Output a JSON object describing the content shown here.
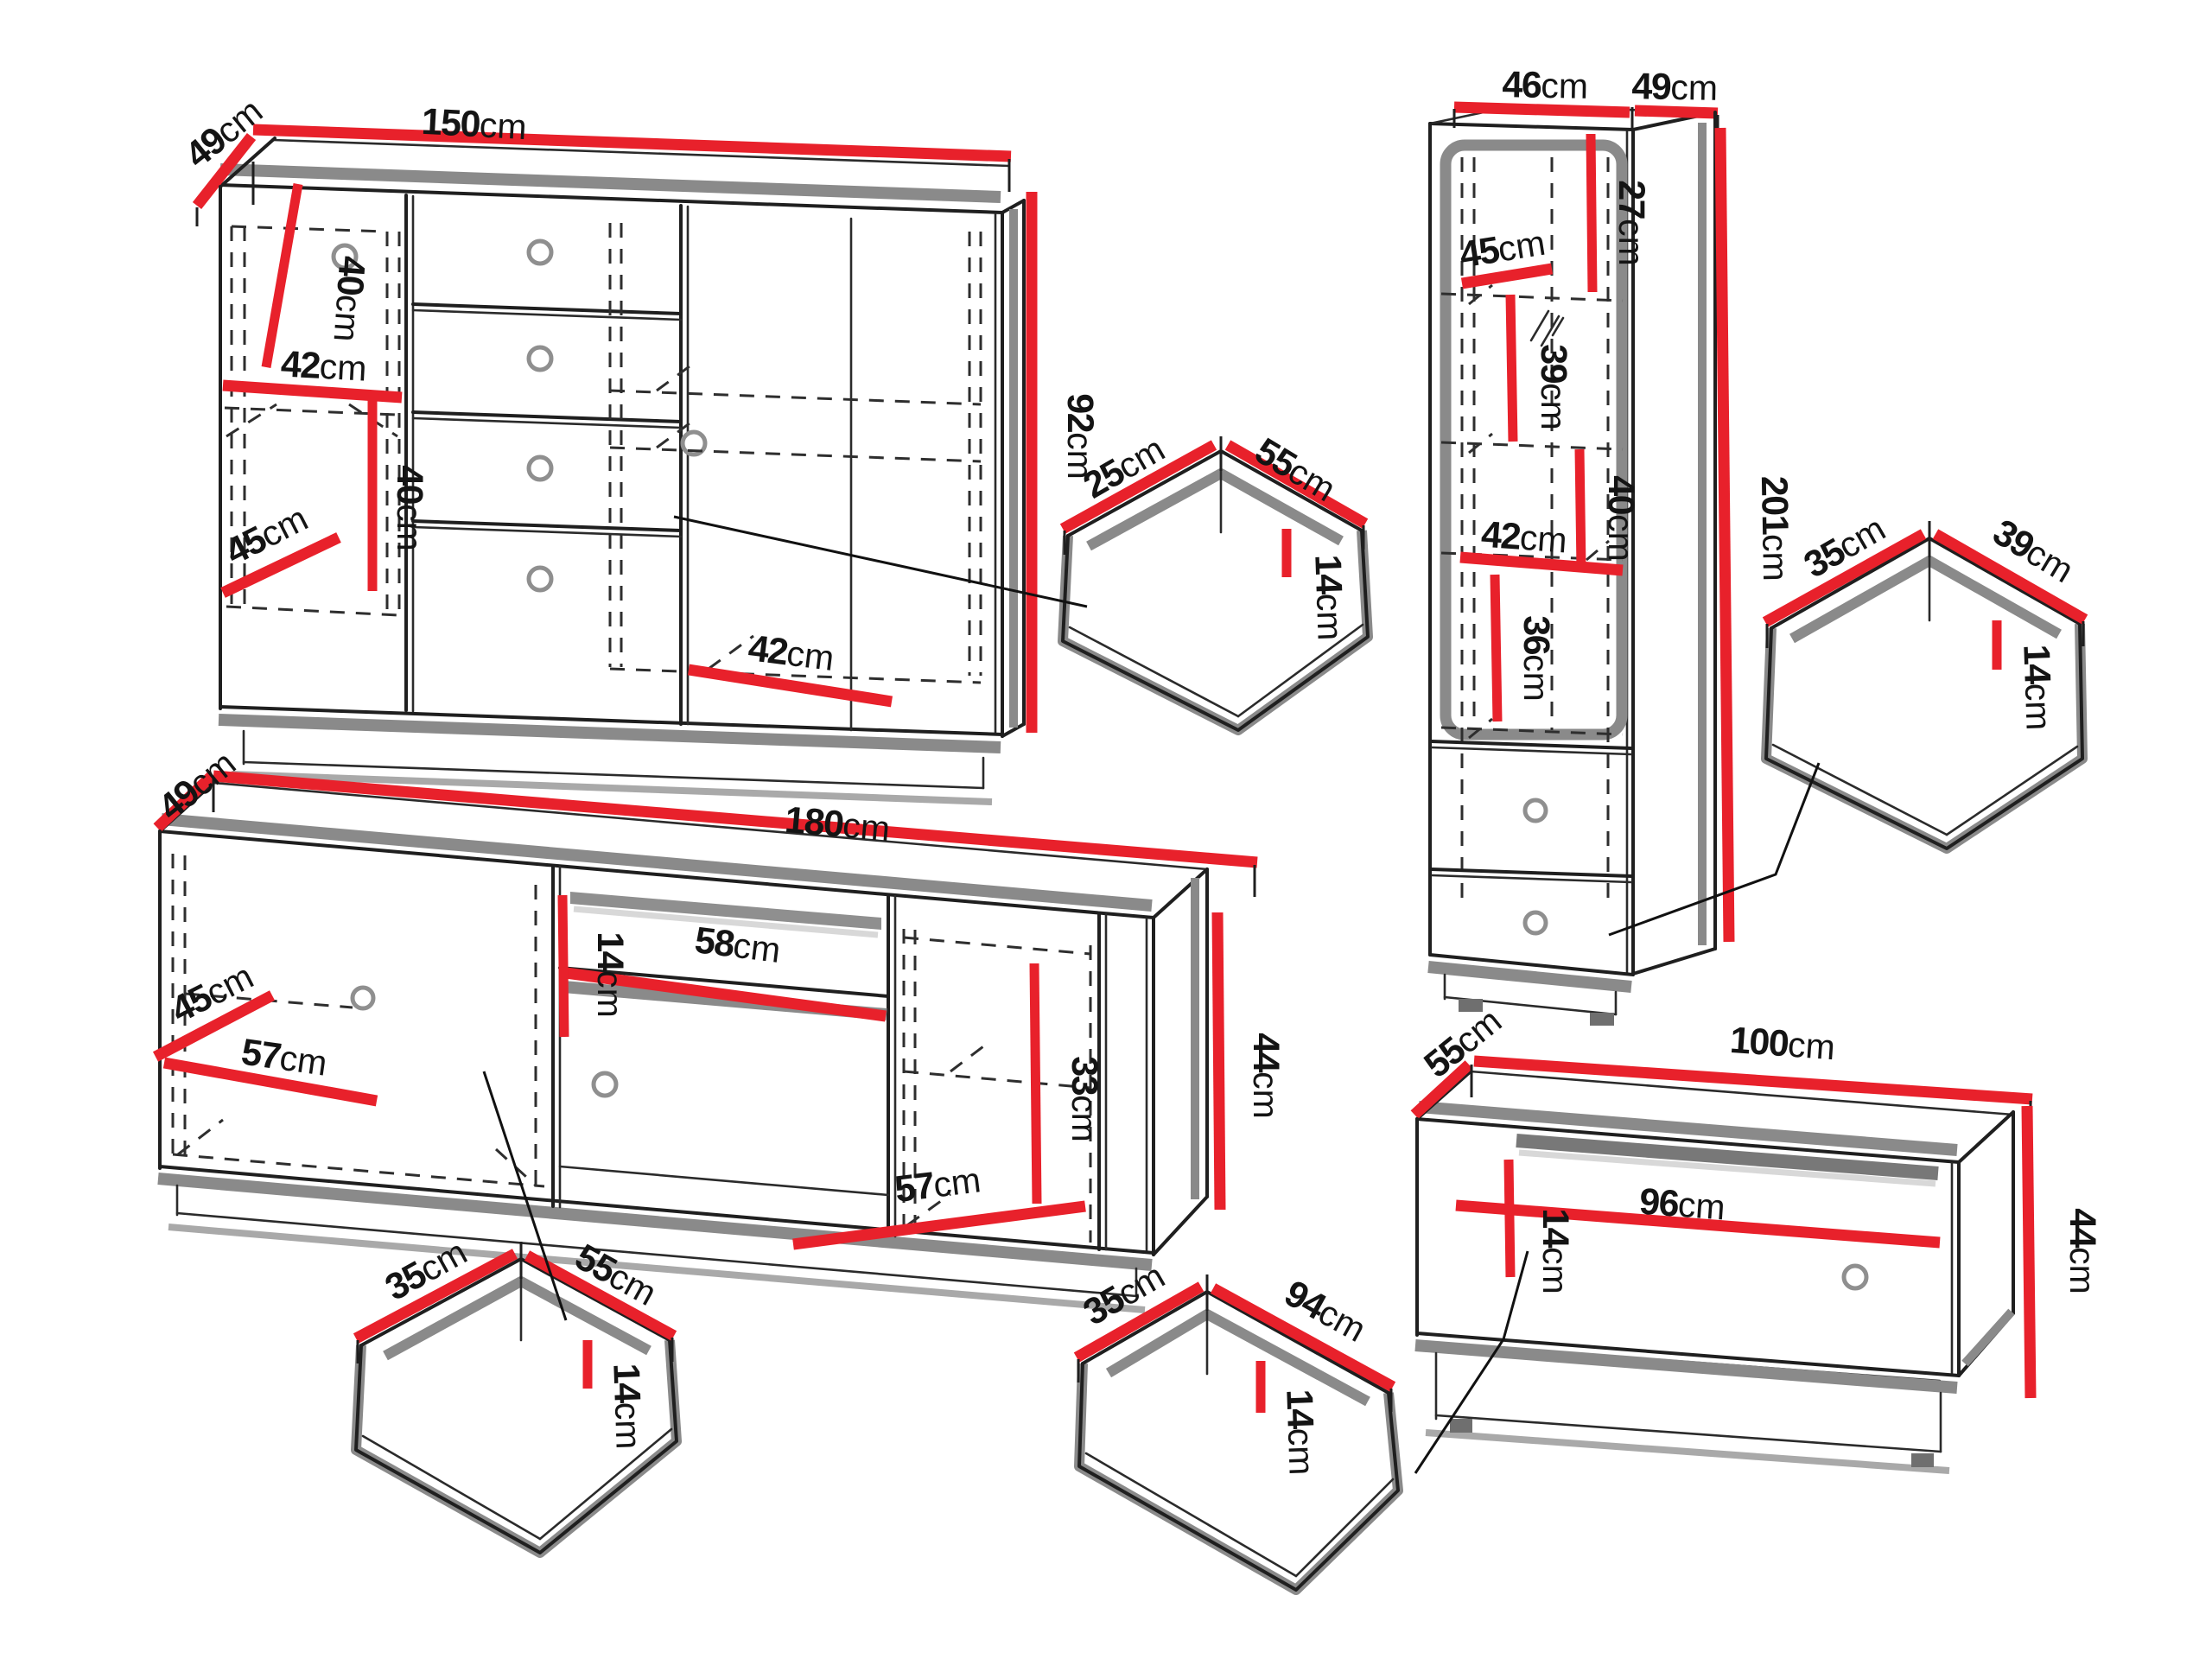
{
  "diagram": "furniture-dimension-drawing",
  "units": "cm",
  "colors": {
    "dimension_line": "#e8212b",
    "shadow_gray": "#8a8a8a",
    "outline": "#1f1f1f"
  },
  "pieces": [
    {
      "name": "sideboard",
      "dims": [
        {
          "value": "49",
          "unit": "cm",
          "role": "depth"
        },
        {
          "value": "150",
          "unit": "cm",
          "role": "width"
        },
        {
          "value": "92",
          "unit": "cm",
          "role": "height"
        },
        {
          "value": "40",
          "unit": "cm",
          "role": "internal"
        },
        {
          "value": "42",
          "unit": "cm",
          "role": "internal"
        },
        {
          "value": "40",
          "unit": "cm",
          "role": "internal"
        },
        {
          "value": "45",
          "unit": "cm",
          "role": "internal"
        },
        {
          "value": "42",
          "unit": "cm",
          "role": "internal"
        }
      ]
    },
    {
      "name": "drawer-55x25",
      "dims": [
        {
          "value": "25",
          "unit": "cm",
          "role": "depth"
        },
        {
          "value": "55",
          "unit": "cm",
          "role": "width"
        },
        {
          "value": "14",
          "unit": "cm",
          "role": "inner-height"
        }
      ]
    },
    {
      "name": "tall-cabinet",
      "dims": [
        {
          "value": "46",
          "unit": "cm",
          "role": "width"
        },
        {
          "value": "49",
          "unit": "cm",
          "role": "depth"
        },
        {
          "value": "27",
          "unit": "cm",
          "role": "internal"
        },
        {
          "value": "45",
          "unit": "cm",
          "role": "internal"
        },
        {
          "value": "39",
          "unit": "cm",
          "role": "internal"
        },
        {
          "value": "40",
          "unit": "cm",
          "role": "internal"
        },
        {
          "value": "42",
          "unit": "cm",
          "role": "internal"
        },
        {
          "value": "36",
          "unit": "cm",
          "role": "internal"
        },
        {
          "value": "201",
          "unit": "cm",
          "role": "height"
        }
      ]
    },
    {
      "name": "drawer-39x35",
      "dims": [
        {
          "value": "35",
          "unit": "cm",
          "role": "depth"
        },
        {
          "value": "39",
          "unit": "cm",
          "role": "width"
        },
        {
          "value": "14",
          "unit": "cm",
          "role": "inner-height"
        }
      ]
    },
    {
      "name": "tv-stand",
      "dims": [
        {
          "value": "49",
          "unit": "cm",
          "role": "depth"
        },
        {
          "value": "180",
          "unit": "cm",
          "role": "width"
        },
        {
          "value": "45",
          "unit": "cm",
          "role": "internal"
        },
        {
          "value": "57",
          "unit": "cm",
          "role": "internal"
        },
        {
          "value": "14",
          "unit": "cm",
          "role": "internal"
        },
        {
          "value": "58",
          "unit": "cm",
          "role": "internal"
        },
        {
          "value": "33",
          "unit": "cm",
          "role": "internal"
        },
        {
          "value": "57",
          "unit": "cm",
          "role": "internal"
        },
        {
          "value": "44",
          "unit": "cm",
          "role": "height"
        }
      ]
    },
    {
      "name": "drawer-55x35",
      "dims": [
        {
          "value": "35",
          "unit": "cm",
          "role": "depth"
        },
        {
          "value": "55",
          "unit": "cm",
          "role": "width"
        },
        {
          "value": "14",
          "unit": "cm",
          "role": "inner-height"
        }
      ]
    },
    {
      "name": "drawer-94x35",
      "dims": [
        {
          "value": "35",
          "unit": "cm",
          "role": "depth"
        },
        {
          "value": "94",
          "unit": "cm",
          "role": "width"
        },
        {
          "value": "14",
          "unit": "cm",
          "role": "inner-height"
        }
      ]
    },
    {
      "name": "tv-bench",
      "dims": [
        {
          "value": "55",
          "unit": "cm",
          "role": "depth"
        },
        {
          "value": "100",
          "unit": "cm",
          "role": "width"
        },
        {
          "value": "14",
          "unit": "cm",
          "role": "internal"
        },
        {
          "value": "96",
          "unit": "cm",
          "role": "internal"
        },
        {
          "value": "44",
          "unit": "cm",
          "role": "height"
        }
      ]
    }
  ]
}
